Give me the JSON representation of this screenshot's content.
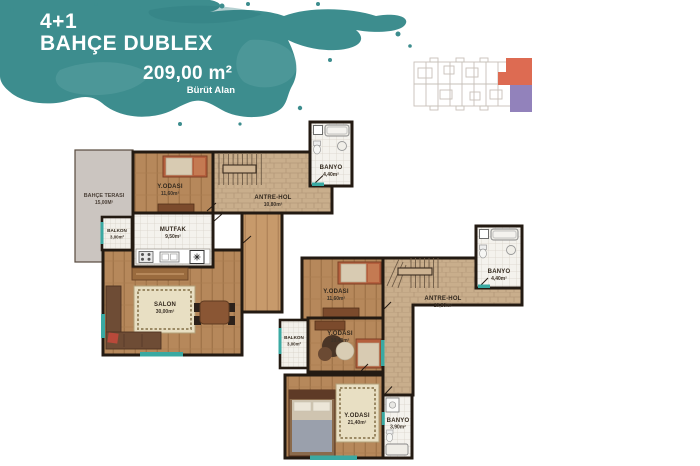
{
  "page": {
    "background": "#ffffff"
  },
  "header": {
    "title_line1": "4+1",
    "title_line2": "BAHÇE DUBLEX",
    "area_value": "209,00 m²",
    "area_label": "Bürüt Alan",
    "splash_color": "#3d8d8e"
  },
  "key_plan": {
    "outline_color": "#c7c0b9",
    "unit_upper_color": "#dd6b52",
    "unit_lower_color": "#9282bb"
  },
  "floor_plans": {
    "accent_color": "#3aa9a2",
    "lower": {
      "rooms": [
        {
          "label": "BAHÇE TERASI",
          "area": "15,00M²"
        },
        {
          "label": "Y.ODASI",
          "area": "11,60m²"
        },
        {
          "label": "BANYO",
          "area": "4,40m²"
        },
        {
          "label": "ANTRE-HOL",
          "area": "10,80m²"
        },
        {
          "label": "MUTFAK",
          "area": "9,50m²"
        },
        {
          "label": "BALKON",
          "area": "3,00m²"
        },
        {
          "label": "SALON",
          "area": "30,00m²"
        }
      ]
    },
    "upper": {
      "rooms": [
        {
          "label": "Y.ODASI",
          "area": "11,60m²"
        },
        {
          "label": "BANYO",
          "area": "4,40m²"
        },
        {
          "label": "ANTRE-HOL",
          "area": "10,80m²"
        },
        {
          "label": "BALKON",
          "area": "3,00m²"
        },
        {
          "label": "Y.ODASI",
          "area": "10,40m²"
        },
        {
          "label": "Y.ODASI",
          "area": "21,40m²"
        },
        {
          "label": "BANYO",
          "area": "3,90m²"
        }
      ]
    }
  }
}
